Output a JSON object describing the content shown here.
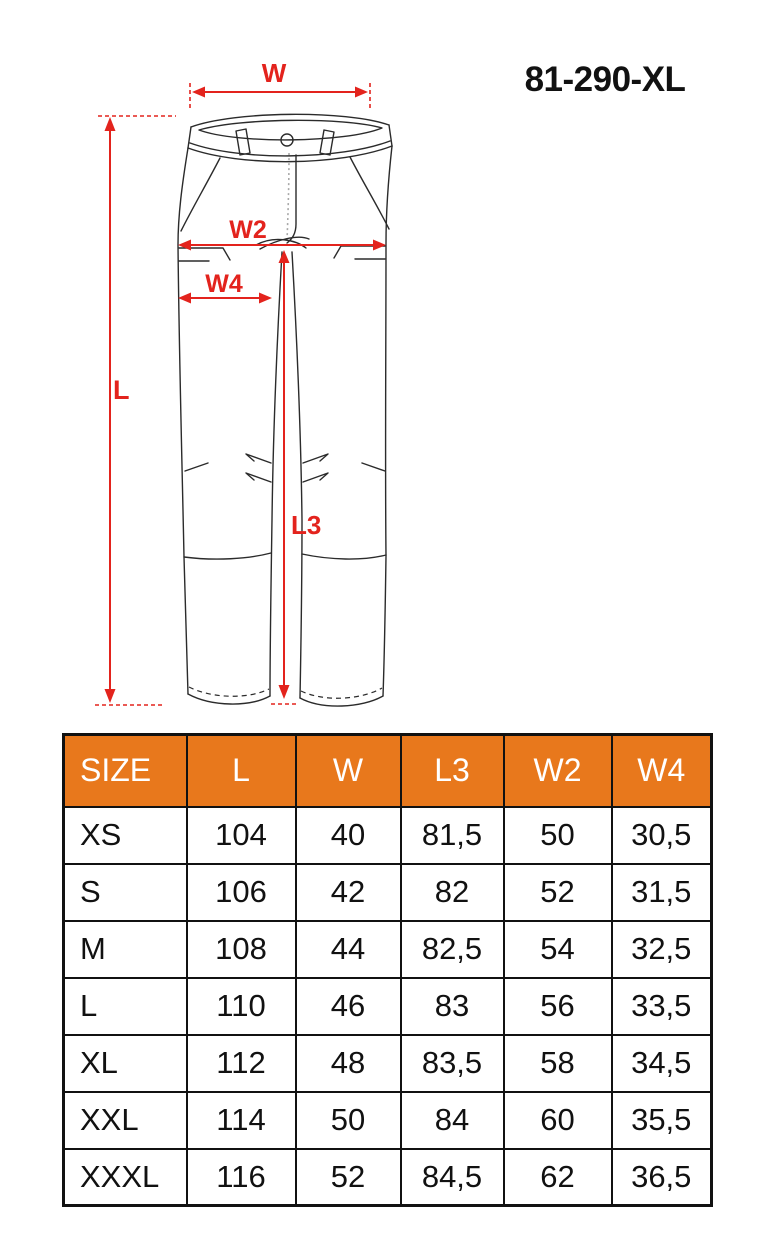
{
  "title": "81-290-XL",
  "diagram": {
    "labels": {
      "w": "W",
      "w2": "W2",
      "w4": "W4",
      "l": "L",
      "l3": "L3"
    }
  },
  "colors": {
    "header_orange": "#e8781c",
    "dimension_red": "#e3231d",
    "line_black": "#2b2b2b",
    "header_text": "#ffffff",
    "body_text": "#111111"
  },
  "size_table": {
    "columns": [
      "SIZE",
      "L",
      "W",
      "L3",
      "W2",
      "W4"
    ],
    "rows": [
      [
        "XS",
        "104",
        "40",
        "81,5",
        "50",
        "30,5"
      ],
      [
        "S",
        "106",
        "42",
        "82",
        "52",
        "31,5"
      ],
      [
        "M",
        "108",
        "44",
        "82,5",
        "54",
        "32,5"
      ],
      [
        "L",
        "110",
        "46",
        "83",
        "56",
        "33,5"
      ],
      [
        "XL",
        "112",
        "48",
        "83,5",
        "58",
        "34,5"
      ],
      [
        "XXL",
        "114",
        "50",
        "84",
        "60",
        "35,5"
      ],
      [
        "XXXL",
        "116",
        "52",
        "84,5",
        "62",
        "36,5"
      ]
    ]
  }
}
